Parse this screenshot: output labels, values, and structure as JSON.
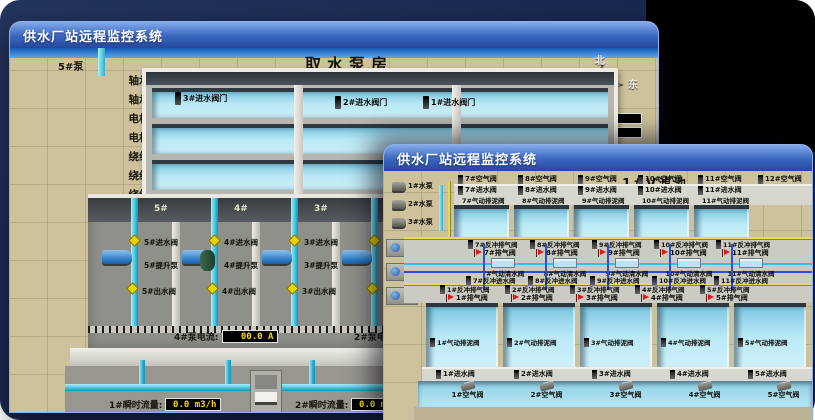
{
  "colors": {
    "display_text": "#ffd900",
    "alarm_flag": "#e01818",
    "water": "#a8dcee",
    "pipe_cyan": "#3fc8e6",
    "valve_yellow": "#e8d200"
  },
  "pump_house_window": {
    "title": "供水厂站远程监控系统",
    "scene_title": "取水泵房",
    "compass": {
      "north": "北",
      "south": "南",
      "west": "西",
      "east": "东"
    },
    "pump5_panel": {
      "title": "5#泵",
      "rows": [
        {
          "label": "轴承温度1:",
          "value": "100.0℃"
        },
        {
          "label": "轴承温度2:",
          "value": "100.0℃"
        },
        {
          "label": "电机温度1:",
          "value": "18.1℃"
        },
        {
          "label": "电机温度2:",
          "value": "17.9℃"
        },
        {
          "label": "绕组温度1:",
          "value": "18.0℃"
        },
        {
          "label": "绕组温度2:",
          "value": "18.1℃"
        },
        {
          "label": "绕组温度3:",
          "value": "18.1℃"
        },
        {
          "label": "管道压力:",
          "value": "0.0007MPa"
        },
        {
          "label": "多功能阀:",
          "value": "0%"
        }
      ]
    },
    "pump1_panel": {
      "rows": [
        {
          "label": "轴承温度1:"
        },
        {
          "label": "轴承温度2:"
        }
      ]
    },
    "intake_valves": [
      "3#进水阀门",
      "2#进水阀门",
      "1#进水阀门"
    ],
    "pump_bays": [
      {
        "bay": "5#",
        "inlet": "5#进水阀",
        "pump": "5#提升泵",
        "outlet": "5#出水阀"
      },
      {
        "bay": "4#",
        "inlet": "4#进水阀",
        "pump": "4#提升泵",
        "outlet": "4#出水阀"
      },
      {
        "bay": "3#",
        "inlet": "3#进水阀",
        "pump": "3#提升泵",
        "outlet": "3#出水阀"
      },
      {
        "bay": "2#",
        "inlet": "2#进水阀",
        "pump": "2#提升泵",
        "outlet": "2#出水阀"
      }
    ],
    "current_meters": [
      {
        "label": "4#泵电流:",
        "value": "00.0 A"
      },
      {
        "label": "2#泵电流:",
        "value": ""
      }
    ],
    "flow_meters": [
      {
        "label": "1#瞬时流量:",
        "value": "0.0 m3/h"
      },
      {
        "label": "2#瞬时流量:",
        "value": "0.0 m3/h"
      }
    ]
  },
  "filter_window": {
    "title": "供水厂站远程监控系统",
    "scene_title": "1#V滤池",
    "pumps": [
      "1#水泵",
      "2#水泵",
      "3#水泵"
    ],
    "fans": [
      "1#风机",
      "2#风机",
      "3#风机"
    ],
    "top_air_valves": [
      "7#空气阀",
      "8#空气阀",
      "9#空气阀",
      "10#空气阀",
      "11#空气阀",
      "12#空气阀"
    ],
    "top_inlet_valves": [
      "7#进水阀",
      "8#进水阀",
      "9#进水阀",
      "10#进水阀",
      "11#进水阀"
    ],
    "top_sludge_valves": [
      "7#气动排泥阀",
      "8#气动排泥阀",
      "9#气动排泥阀",
      "10#气动排泥阀",
      "11#气动排泥阀"
    ],
    "top_backwash_exhaust_valves": [
      "7#反冲排气阀",
      "8#反冲排气阀",
      "9#反冲排气阀",
      "10#反冲排气阀",
      "11#反冲排气阀"
    ],
    "top_exhaust_valves": [
      "7#排气阀",
      "8#排气阀",
      "9#排气阀",
      "10#排气阀",
      "11#排气阀"
    ],
    "top_clear_valves": [
      "7#气动清水阀",
      "8#气动清水阀",
      "9#气动清水阀",
      "10#气动清水阀",
      "11#气动清水阀"
    ],
    "top_backwash_inlet_valves": [
      "7#反冲进水阀",
      "8#反冲进水阀",
      "9#反冲进水阀",
      "10#反冲进水阀",
      "11#反冲进水阀"
    ],
    "bottom_backwash_exhaust_valves": [
      "1#反冲排气阀",
      "2#反冲排气阀",
      "3#反冲排气阀",
      "4#反冲排气阀",
      "5#反冲排气阀"
    ],
    "bottom_exhaust_valves": [
      "1#排气阀",
      "2#排气阀",
      "3#排气阀",
      "4#排气阀",
      "5#排气阀"
    ],
    "bottom_sludge_valves": [
      "1#气动排泥阀",
      "2#气动排泥阀",
      "3#气动排泥阀",
      "4#气动排泥阀",
      "5#气动排泥阀"
    ],
    "bottom_inlet_valves": [
      "1#进水阀",
      "2#进水阀",
      "3#进水阀",
      "4#进水阀",
      "5#进水阀"
    ],
    "bottom_air_valves": [
      "1#空气阀",
      "2#空气阀",
      "3#空气阀",
      "4#空气阀",
      "5#空气阀"
    ]
  }
}
